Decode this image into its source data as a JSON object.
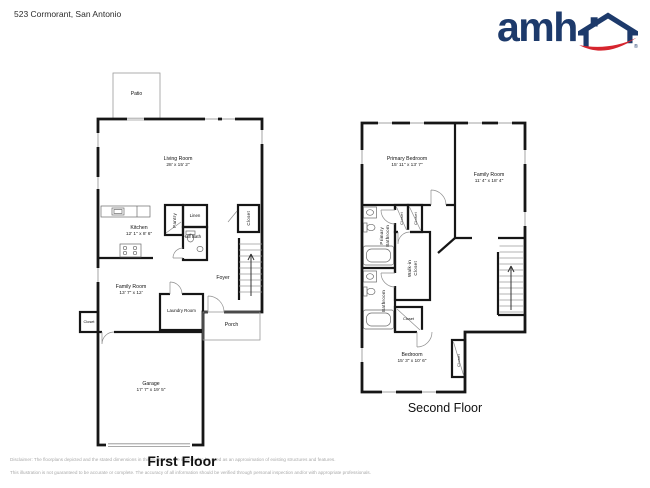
{
  "header": {
    "address": "523 Cormorant, San Antonio",
    "logo_text": "amh",
    "logo_registered": "®"
  },
  "first_floor": {
    "label": "First Floor",
    "rooms": {
      "patio": {
        "name": "Patio"
      },
      "living_room": {
        "name": "Living Room",
        "dims": "28' x 15' 2\""
      },
      "kitchen": {
        "name": "Kitchen",
        "dims": "12' 1\" x 8' 6\""
      },
      "pantry": {
        "name": "Pantry"
      },
      "linen": {
        "name": "Linen"
      },
      "half_bath": {
        "name": "Half Bath"
      },
      "closet_stairs": {
        "name": "Closet"
      },
      "foyer": {
        "name": "Foyer"
      },
      "family_room": {
        "name": "Family Room",
        "dims": "13' 7\" x 12'"
      },
      "closet_left": {
        "name": "Closet"
      },
      "laundry": {
        "name": "Laundry Room"
      },
      "porch": {
        "name": "Porch"
      },
      "garage": {
        "name": "Garage",
        "dims": "17' 7\" x 19' 5\""
      }
    }
  },
  "second_floor": {
    "label": "Second Floor",
    "rooms": {
      "primary_bedroom": {
        "name": "Primary Bedroom",
        "dims": "15' 11\" x 13' 7\""
      },
      "family_room": {
        "name": "Family Room",
        "dims": "11' 4\" x 18' 4\""
      },
      "closet_a": {
        "name": "Closet"
      },
      "closet_b": {
        "name": "Closet"
      },
      "primary_bathroom": {
        "name": "Primary Bathroom",
        "lines": [
          "Primary",
          "Bathroom"
        ]
      },
      "walk_in_closet": {
        "name": "Walk-in Closet",
        "lines": [
          "Walk-in",
          "Closet"
        ]
      },
      "bathroom": {
        "name": "Bathroom"
      },
      "closet_hall": {
        "name": "Closet"
      },
      "bedroom": {
        "name": "Bedroom",
        "dims": "15' 3\" x 10' 6\""
      },
      "closet_bedroom": {
        "name": "Closet"
      }
    }
  },
  "footer": {
    "disclaimer_line1": "Disclaimer: The floorplans depicted and the stated dimensions in this illustration are intended to be used as an approximation of existing structures and features.",
    "disclaimer_line2": "This illustration is not guaranteed to be accurate or complete. The accuracy of all information should be verified through personal inspection and/or with appropriate professionals."
  },
  "colors": {
    "brand_navy": "#1d3a6b",
    "brand_red": "#d6252e",
    "wall": "#161616",
    "disclaimer_gray": "#aaaaaa"
  }
}
